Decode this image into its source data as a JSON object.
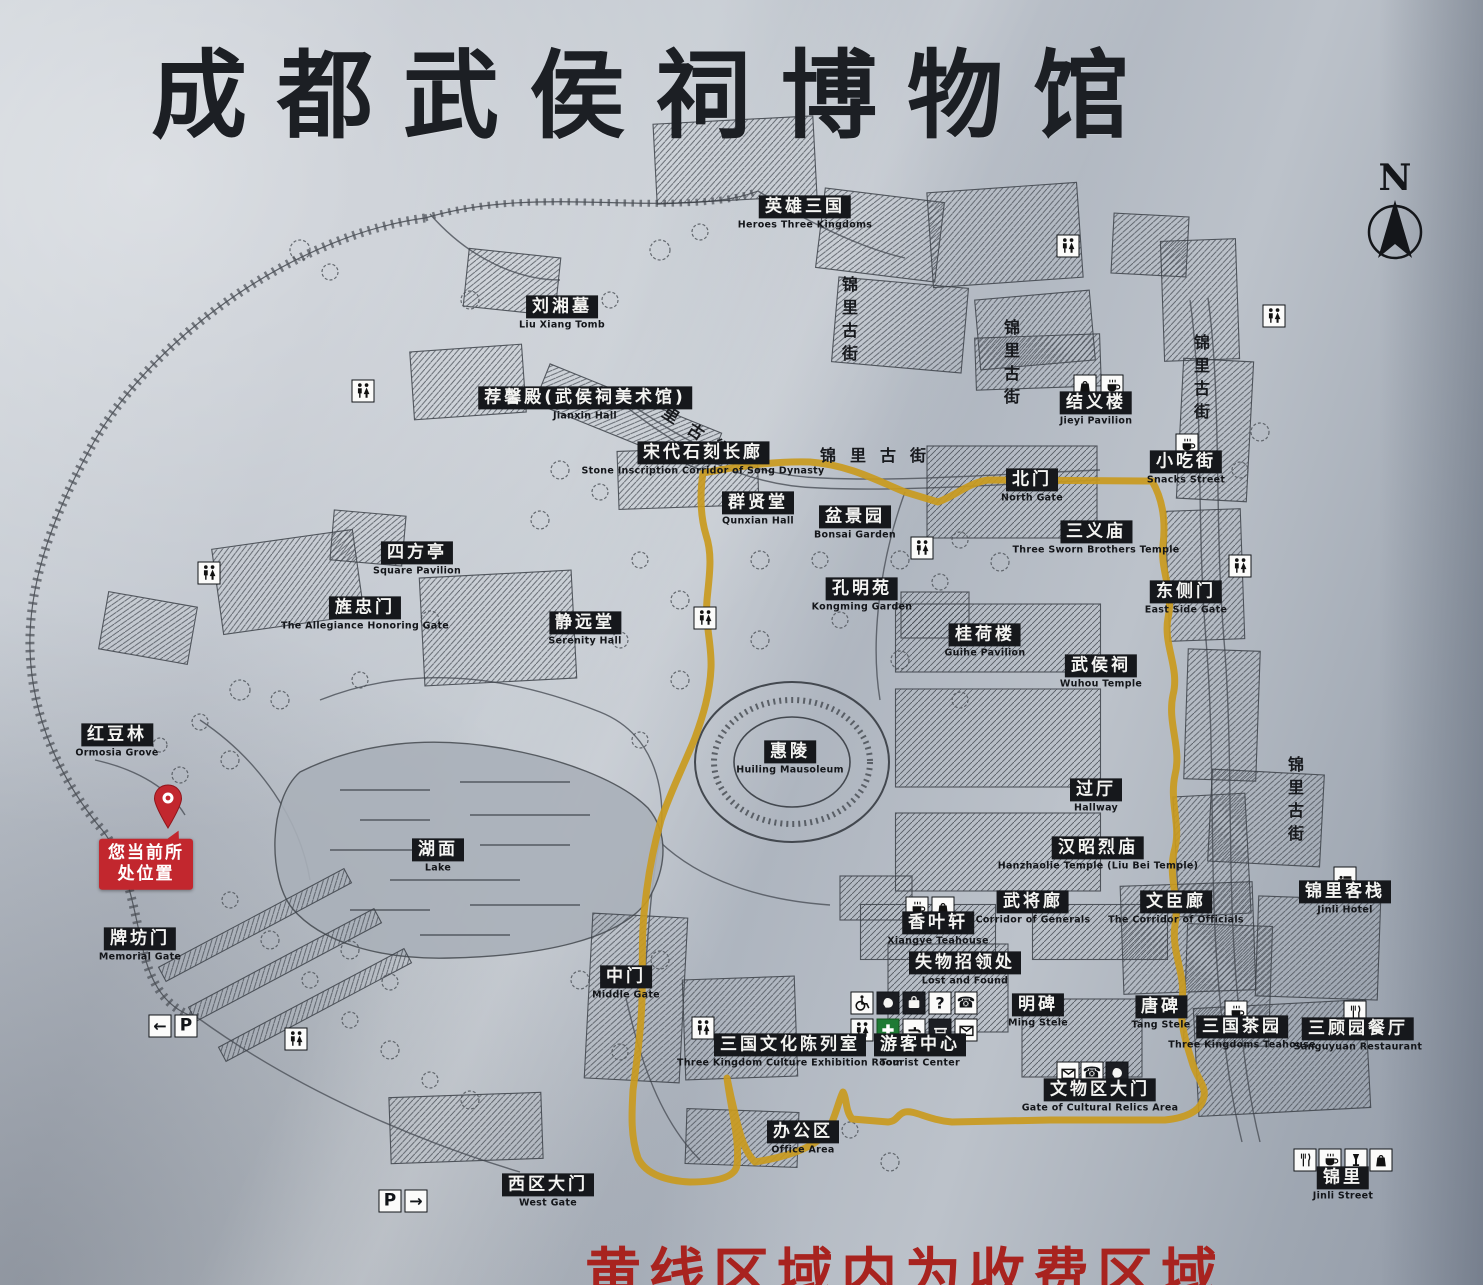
{
  "title": "成都武侯祠博物馆",
  "compass": "N",
  "notice": "黄线区域内为收费区域",
  "you_are_here": {
    "line1": "您当前所",
    "line2": "处位置"
  },
  "colors": {
    "route_yellow": "#c99a1e",
    "badge_red": "#c2272e",
    "notice_red": "#a8231f",
    "ink": "#1a1c20",
    "first_aid_green": "#1e7a34"
  },
  "map": {
    "labels": [
      {
        "zh": "英雄三国",
        "en": "Heroes Three Kingdoms",
        "x": 805,
        "y": 213
      },
      {
        "zh": "刘湘墓",
        "en": "Liu Xiang Tomb",
        "x": 562,
        "y": 313
      },
      {
        "zh": "荐馨殿(武侯祠美术馆)",
        "en": "Jianxin Hall",
        "x": 585,
        "y": 404
      },
      {
        "zh": "宋代石刻长廊",
        "en": "Stone Inscription Corridor of Song Dynasty",
        "x": 703,
        "y": 459
      },
      {
        "zh": "群贤堂",
        "en": "Qunxian Hall",
        "x": 758,
        "y": 509
      },
      {
        "zh": "盆景园",
        "en": "Bonsai Garden",
        "x": 855,
        "y": 523
      },
      {
        "zh": "孔明苑",
        "en": "Kongming Garden",
        "x": 862,
        "y": 595
      },
      {
        "zh": "四方亭",
        "en": "Square Pavilion",
        "x": 417,
        "y": 559
      },
      {
        "zh": "旌忠门",
        "en": "The Allegiance Honoring Gate",
        "x": 365,
        "y": 614
      },
      {
        "zh": "静远堂",
        "en": "Serenity Hall",
        "x": 585,
        "y": 629
      },
      {
        "zh": "红豆林",
        "en": "Ormosia Grove",
        "x": 117,
        "y": 741
      },
      {
        "zh": "牌坊门",
        "en": "Memorial Gate",
        "x": 140,
        "y": 945
      },
      {
        "zh": "湖面",
        "en": "Lake",
        "x": 438,
        "y": 856
      },
      {
        "zh": "惠陵",
        "en": "Huiling Mausoleum",
        "x": 790,
        "y": 758
      },
      {
        "zh": "中门",
        "en": "Middle Gate",
        "x": 626,
        "y": 983
      },
      {
        "zh": "西区大门",
        "en": "West Gate",
        "x": 548,
        "y": 1191
      },
      {
        "zh": "办公区",
        "en": "Office Area",
        "x": 803,
        "y": 1138
      },
      {
        "zh": "三国文化陈列室",
        "en": "Three Kingdom Culture Exhibition Room",
        "x": 790,
        "y": 1051
      },
      {
        "zh": "游客中心",
        "en": "Tourist Center",
        "x": 920,
        "y": 1051
      },
      {
        "zh": "失物招领处",
        "en": "Lost and Found",
        "x": 965,
        "y": 969
      },
      {
        "zh": "香叶轩",
        "en": "Xiangye Teahouse",
        "x": 938,
        "y": 929
      },
      {
        "zh": "武将廊",
        "en": "Corridor of Generals",
        "x": 1033,
        "y": 908
      },
      {
        "zh": "文臣廊",
        "en": "The Corridor of Officials",
        "x": 1176,
        "y": 908
      },
      {
        "zh": "明碑",
        "en": "Ming Stele",
        "x": 1038,
        "y": 1011
      },
      {
        "zh": "唐碑",
        "en": "Tang Stele",
        "x": 1161,
        "y": 1013
      },
      {
        "zh": "文物区大门",
        "en": "Gate of Cultural Relics Area",
        "x": 1100,
        "y": 1096
      },
      {
        "zh": "汉昭烈庙",
        "en": "Hanzhaolie Temple (Liu Bei Temple)",
        "x": 1098,
        "y": 854
      },
      {
        "zh": "过厅",
        "en": "Hallway",
        "x": 1096,
        "y": 796
      },
      {
        "zh": "武侯祠",
        "en": "Wuhou Temple",
        "x": 1101,
        "y": 672
      },
      {
        "zh": "桂荷楼",
        "en": "Guihe Pavilion",
        "x": 985,
        "y": 641
      },
      {
        "zh": "三义庙",
        "en": "Three Sworn Brothers Temple",
        "x": 1096,
        "y": 538
      },
      {
        "zh": "北门",
        "en": "North Gate",
        "x": 1032,
        "y": 486
      },
      {
        "zh": "小吃街",
        "en": "Snacks Street",
        "x": 1186,
        "y": 468
      },
      {
        "zh": "东侧门",
        "en": "East Side Gate",
        "x": 1186,
        "y": 598
      },
      {
        "zh": "结义楼",
        "en": "Jieyi Pavilion",
        "x": 1096,
        "y": 409
      },
      {
        "zh": "三国茶园",
        "en": "Three Kingdoms Teahouse",
        "x": 1242,
        "y": 1033
      },
      {
        "zh": "三顾园餐厅",
        "en": "Sanguyuan Restaurant",
        "x": 1358,
        "y": 1035
      },
      {
        "zh": "锦里客栈",
        "en": "Jinli Hotel",
        "x": 1345,
        "y": 898
      },
      {
        "zh": "锦里",
        "en": "Jinli Street",
        "x": 1343,
        "y": 1184
      }
    ],
    "street_labels": [
      {
        "text": "锦里古街",
        "x": 848,
        "y": 322,
        "mode": "v",
        "angle": 0
      },
      {
        "text": "锦里古街",
        "x": 1010,
        "y": 365,
        "mode": "v",
        "angle": 0
      },
      {
        "text": "锦里古街",
        "x": 690,
        "y": 426,
        "mode": "d",
        "angle": 33
      },
      {
        "text": "锦里古街",
        "x": 880,
        "y": 454,
        "mode": "h",
        "angle": 0
      },
      {
        "text": "锦里古街",
        "x": 1200,
        "y": 380,
        "mode": "v",
        "angle": 0
      },
      {
        "text": "锦里古街",
        "x": 1294,
        "y": 802,
        "mode": "v",
        "angle": 0
      }
    ],
    "icons": [
      {
        "type": "restroom",
        "x": 363,
        "y": 391
      },
      {
        "type": "restroom",
        "x": 209,
        "y": 573
      },
      {
        "type": "restroom",
        "x": 705,
        "y": 618
      },
      {
        "type": "restroom",
        "x": 922,
        "y": 548
      },
      {
        "type": "restroom",
        "x": 1068,
        "y": 246
      },
      {
        "type": "restroom",
        "x": 1274,
        "y": 316
      },
      {
        "type": "restroom",
        "x": 703,
        "y": 1028
      },
      {
        "type": "restroom",
        "x": 296,
        "y": 1039
      },
      {
        "type": "restroom",
        "x": 1240,
        "y": 566
      },
      {
        "type": "cup",
        "x": 1187,
        "y": 445
      },
      {
        "type": "shop",
        "x": 1085,
        "y": 386
      },
      {
        "type": "cup",
        "x": 1112,
        "y": 386
      },
      {
        "type": "cup",
        "x": 917,
        "y": 908
      },
      {
        "type": "shop",
        "x": 943,
        "y": 908
      },
      {
        "type": "bed",
        "x": 1345,
        "y": 878
      },
      {
        "type": "cup",
        "x": 1236,
        "y": 1012
      },
      {
        "type": "fork",
        "x": 1355,
        "y": 1012
      },
      {
        "type": "fork",
        "x": 1305,
        "y": 1160
      },
      {
        "type": "cup",
        "x": 1330,
        "y": 1160
      },
      {
        "type": "wine",
        "x": 1356,
        "y": 1160
      },
      {
        "type": "shop",
        "x": 1381,
        "y": 1160
      },
      {
        "type": "mail",
        "x": 1068,
        "y": 1073
      },
      {
        "type": "phone",
        "x": 1092,
        "y": 1073
      },
      {
        "type": "hand",
        "x": 1117,
        "y": 1073
      },
      {
        "type": "wheelchair",
        "x": 862,
        "y": 1003
      },
      {
        "type": "hand",
        "x": 888,
        "y": 1003
      },
      {
        "type": "bag",
        "x": 914,
        "y": 1003
      },
      {
        "type": "question",
        "x": 940,
        "y": 1003
      },
      {
        "type": "phone",
        "x": 966,
        "y": 1003
      },
      {
        "type": "restroom",
        "x": 862,
        "y": 1030
      },
      {
        "type": "firstaid",
        "x": 888,
        "y": 1030
      },
      {
        "type": "water",
        "x": 914,
        "y": 1030
      },
      {
        "type": "desk",
        "x": 940,
        "y": 1030
      },
      {
        "type": "mail",
        "x": 966,
        "y": 1030
      },
      {
        "type": "arrow-left",
        "x": 160,
        "y": 1026
      },
      {
        "type": "parking",
        "x": 186,
        "y": 1026
      },
      {
        "type": "parking",
        "x": 390,
        "y": 1201
      },
      {
        "type": "arrow-right",
        "x": 416,
        "y": 1201
      }
    ]
  }
}
